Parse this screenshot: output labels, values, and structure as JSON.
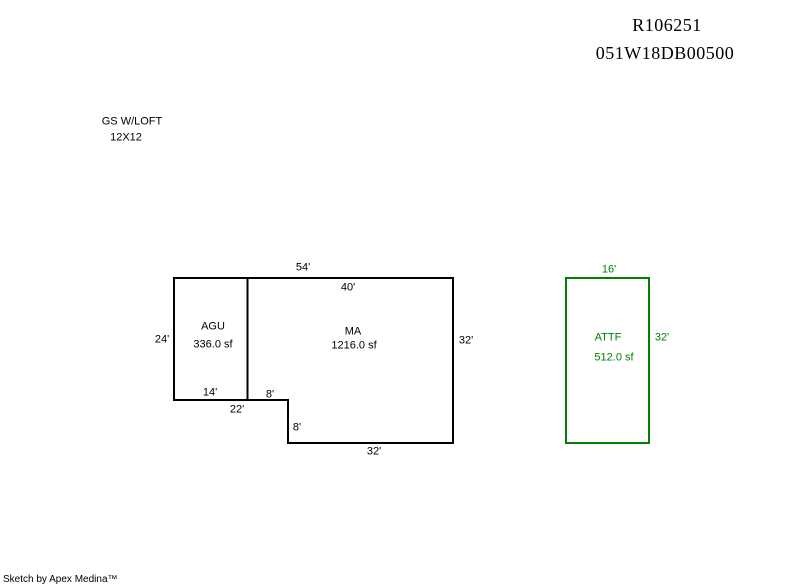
{
  "page": {
    "background": "#ffffff"
  },
  "header": {
    "line1": "R106251",
    "line2": "051W18DB00500"
  },
  "annotation": {
    "line1": "GS W/LOFT",
    "line2": "12X12"
  },
  "main_building": {
    "line_color": "#000000",
    "sections": [
      {
        "code": "AGU",
        "area": "336.0 sf"
      },
      {
        "code": "MA",
        "area": "1216.0 sf"
      }
    ],
    "dims": {
      "top": "54'",
      "top_inner": "40'",
      "left": "24'",
      "right": "32'",
      "inner_bottom": "14'",
      "outer_bottom": "22'",
      "notch_top": "8'",
      "notch_side": "8'",
      "bottom": "32'"
    }
  },
  "attf_building": {
    "line_color": "#008000",
    "code": "ATTF",
    "area": "512.0 sf",
    "dims": {
      "top": "16'",
      "right": "32'"
    }
  },
  "footer": {
    "credit": "Sketch by Apex Medina™"
  }
}
